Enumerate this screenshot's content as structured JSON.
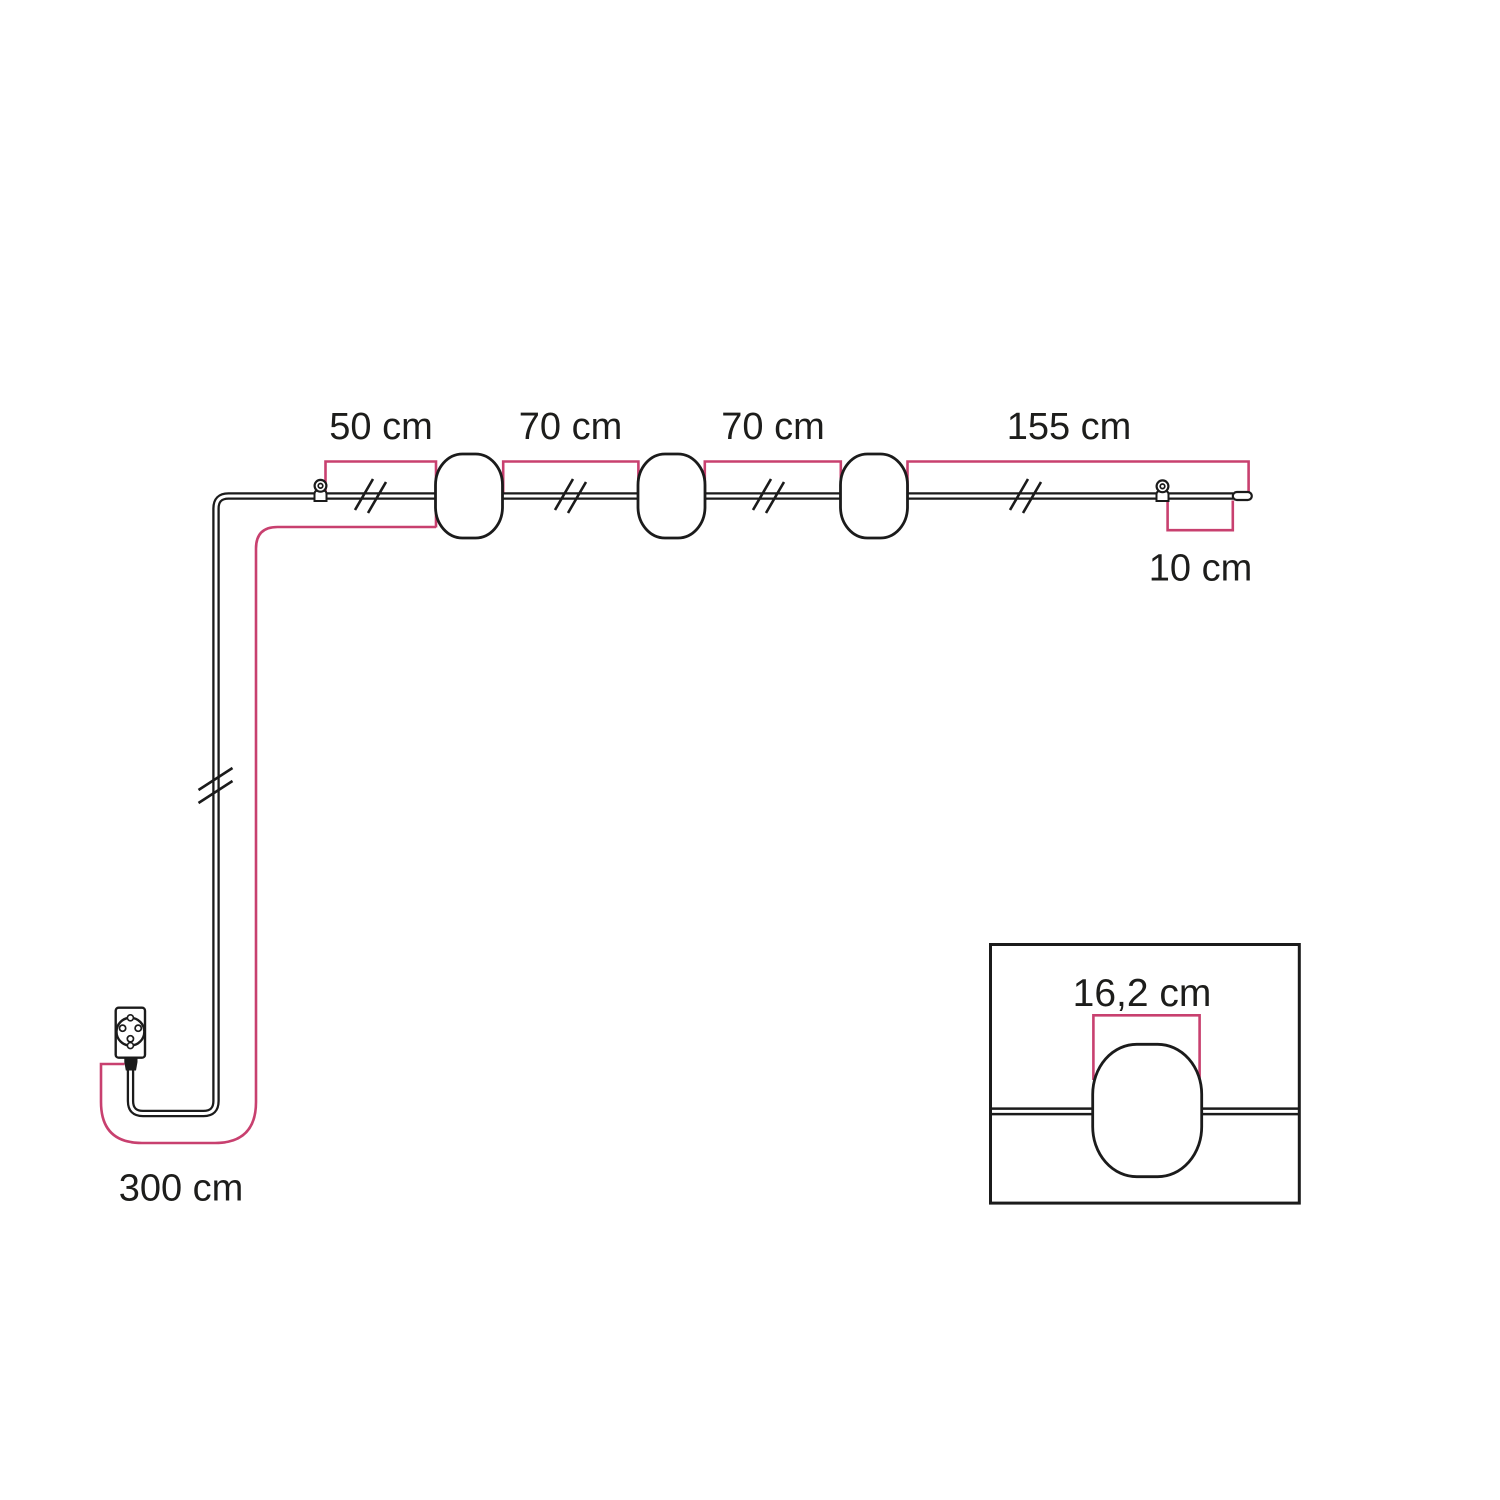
{
  "diagram": {
    "title": "string-light-dimension-diagram",
    "colors": {
      "line": "#1B1B1B",
      "dimension": "#C8406F",
      "text": "#1D1D1B",
      "background": "#FFFFFF"
    },
    "labels": {
      "span_hook_to_lamp1": "50 cm",
      "span_lamp1_to_lamp2": "70 cm",
      "span_lamp2_to_lamp3": "70 cm",
      "span_lamp3_to_end": "155 cm",
      "span_hook2_to_tip": "10 cm",
      "span_plug_to_lamp1": "300 cm",
      "lamp_width": "16,2 cm"
    },
    "components": {
      "plug": "schuko-plug",
      "hooks": "ceiling-hook",
      "lamps": "lamp-holder",
      "cable_end": "cable-end-cap",
      "break_marks": "cable-break-mark",
      "inset": "lamp-width-detail"
    }
  }
}
